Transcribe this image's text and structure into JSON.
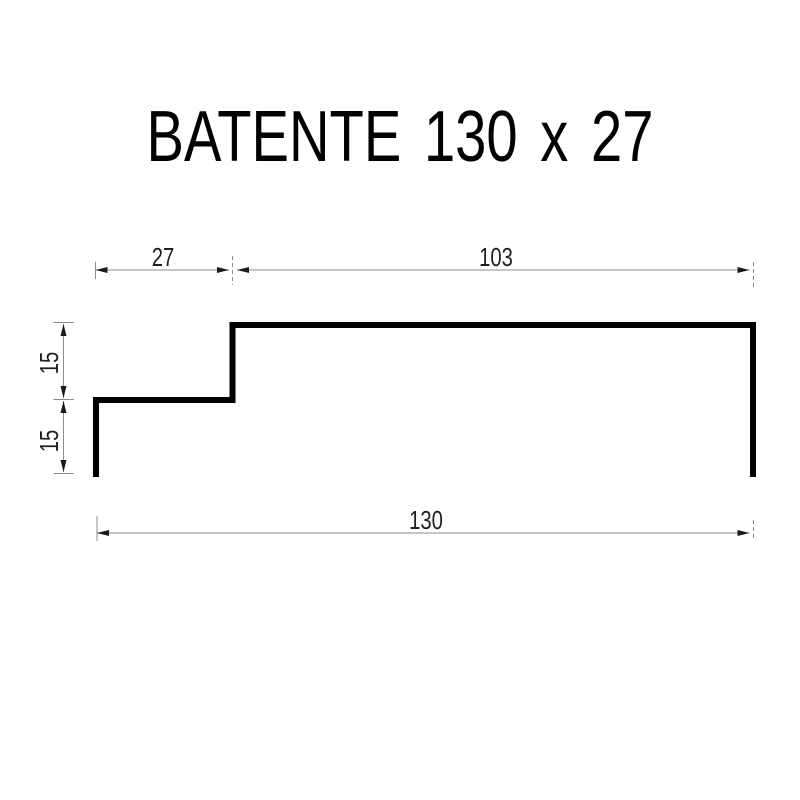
{
  "title": "BATENTE 130 x 27",
  "dimensions": {
    "top_left_width": "27",
    "top_right_width": "103",
    "left_upper_height": "15",
    "left_lower_height": "15",
    "bottom_total_width": "130"
  },
  "colors": {
    "background": "#ffffff",
    "profile_line": "#000000",
    "dimension_line": "#8c8c8c",
    "dimension_text": "#1f1f1f",
    "arrowhead": "#1a1a1a",
    "title_text": "#000000"
  }
}
